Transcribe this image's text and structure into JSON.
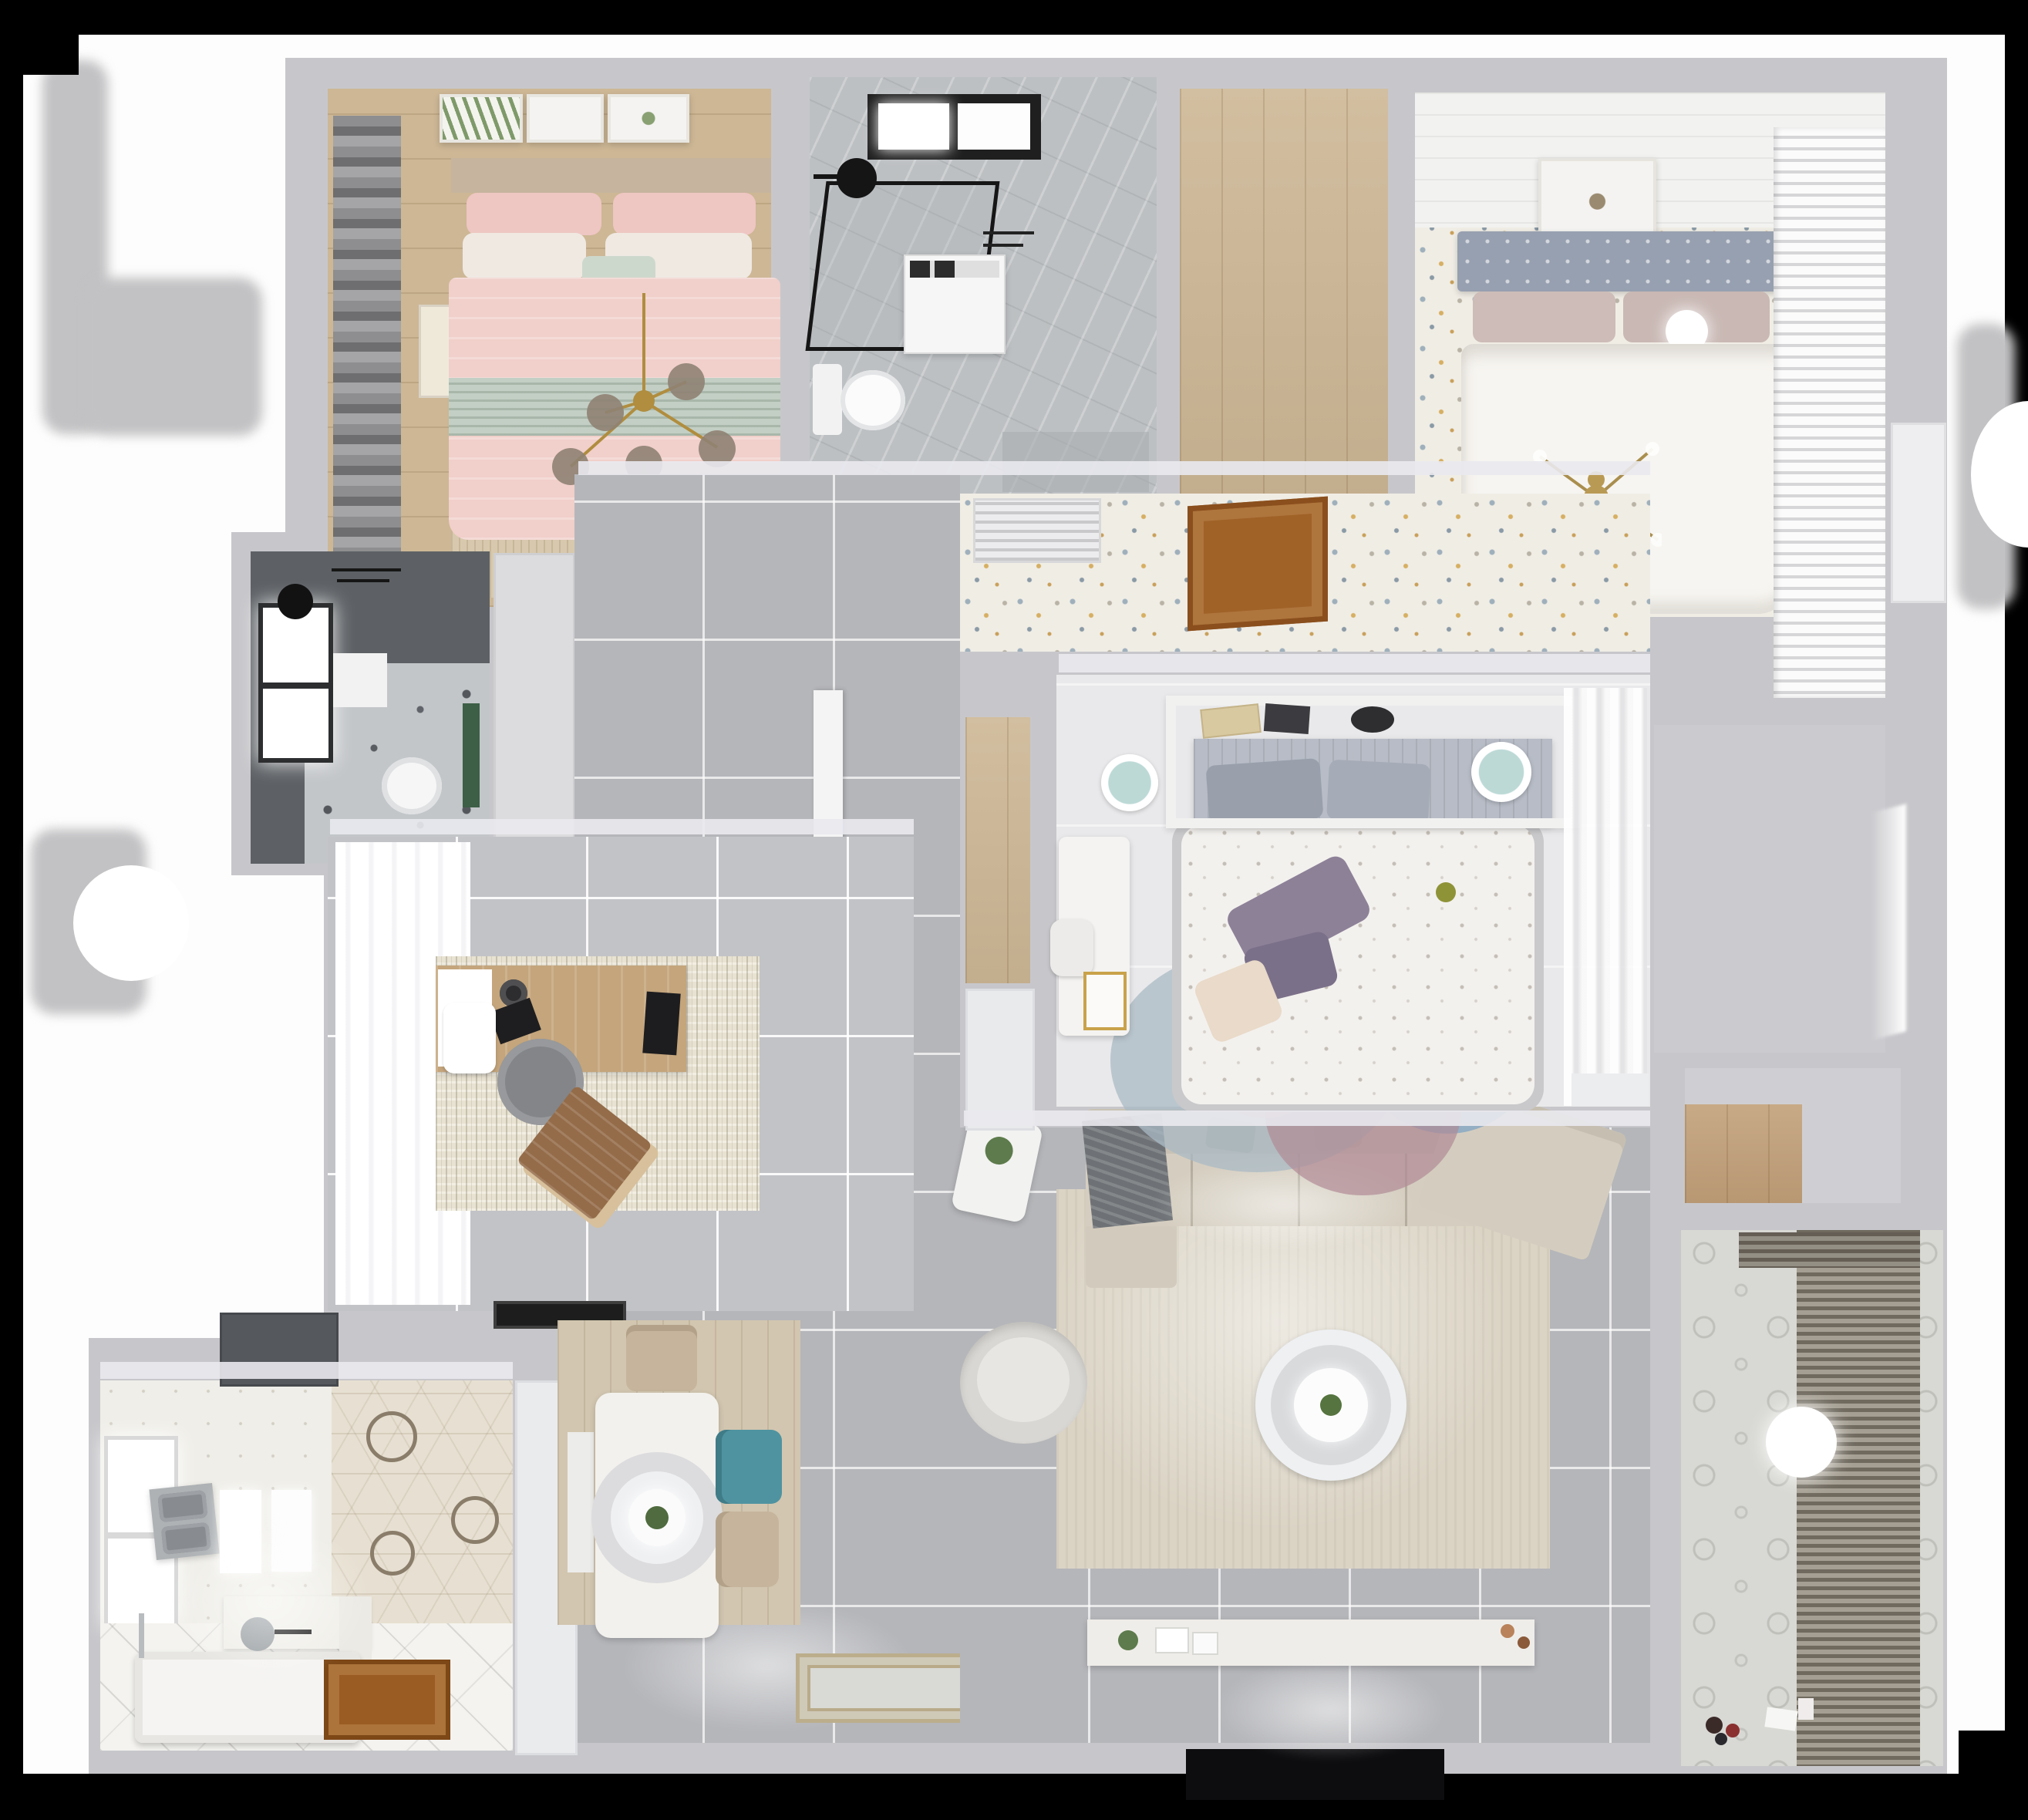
{
  "meta": {
    "title": "Top-down 3D dollhouse render of a furnished apartment floor plan",
    "view": "overhead cutaway, no visible text or UI controls"
  },
  "palette": {
    "canvas": "#fdfdfd",
    "wall": "#c7c7cb",
    "tile": "#b5b6ba",
    "wood": "#cdb795",
    "speckle": "#f0ede5",
    "pink": "#f1cfca",
    "sage": "#c3cfc4",
    "teal": "#4f93a0",
    "purple": "#8d8198",
    "sofa": "#d5cec0",
    "rugliving": "#dbd4c5",
    "doorwood": "#a06227",
    "blinds": "#6f695e",
    "headboard": "#97a0b0",
    "tv": "#0d0d0f",
    "plant": "#5d7b4c",
    "gold": "#b08d3f"
  },
  "rooms": [
    {
      "id": "bedroom-1",
      "name": "Bedroom 1 - blush bedroom",
      "items": [
        "double bed with blush duvet",
        "sage throw band",
        "gold branch chandelier",
        "three gallery frames",
        "roman shade curtains",
        "beige rug",
        "foot bench",
        "oak floor"
      ]
    },
    {
      "id": "bathroom-1",
      "name": "Bathroom 1 - marble shower room",
      "items": [
        "black framed walk-in shower",
        "black shower head",
        "skylight window",
        "toilet",
        "washing machine",
        "marble floor"
      ]
    },
    {
      "id": "closet",
      "name": "Walk-in closet",
      "items": [
        "oak plank floor"
      ]
    },
    {
      "id": "bedroom-2",
      "name": "Bedroom 2 - master bedroom",
      "items": [
        "white duvet double bed",
        "tufted blue-grey headboard",
        "mauve pillows",
        "sphere table lamp",
        "gold sputnik chandelier",
        "louvered wardrobe",
        "wall art",
        "confetti speckle carpet",
        "plank ceiling"
      ]
    },
    {
      "id": "corridor",
      "name": "Corridor",
      "items": [
        "air conditioning vent grille",
        "open wooden door",
        "potted plant on half wall"
      ]
    },
    {
      "id": "bathroom-2",
      "name": "Bathroom 2 - dark tiled shower",
      "items": [
        "ceiling shower head",
        "toilet",
        "window",
        "white bath mat",
        "green accent panel",
        "marble floor patch"
      ]
    },
    {
      "id": "hallway",
      "name": "Hallway",
      "items": [
        "grey porcelain floor tiles",
        "white door leaf"
      ]
    },
    {
      "id": "bedroom-3",
      "name": "Bedroom 3 - teen bedroom",
      "items": [
        "bed with floral duvet",
        "plum cushions",
        "cream cushion",
        "shelf headboard with books",
        "white desk and chair",
        "gold cart",
        "two teal poufs",
        "pastel circles rug",
        "sheer curtains",
        "oak niche",
        "white closet front"
      ]
    },
    {
      "id": "study",
      "name": "Study",
      "items": [
        "wooden desk",
        "monitor",
        "camera and lens",
        "white side chair",
        "grey desk chair",
        "tan lounge chair",
        "distressed rug",
        "sheer curtains",
        "black doormat"
      ]
    },
    {
      "id": "bathroom-3",
      "name": "Bathroom 3 - family bath",
      "items": [
        "freestanding bathtub",
        "floor standing tub filler",
        "wall mixer with spout",
        "stainless double sink",
        "twin glowing mirrors",
        "hexagon feature wall",
        "half wall counter",
        "wooden door",
        "window",
        "water heater box"
      ]
    },
    {
      "id": "dining",
      "name": "Dining area",
      "items": [
        "white dining table",
        "ring pendant lamp with plant",
        "teal chair",
        "two beige chairs",
        "white bench",
        "wood-look rug",
        "ornate entry mat"
      ]
    },
    {
      "id": "living",
      "name": "Living room",
      "items": [
        "L-shaped sectional sofa",
        "angled chaise",
        "grey throw",
        "two-tier round coffee table",
        "barrel armchair",
        "side table with plant",
        "TV console with decor",
        "wall TV",
        "large beige rug"
      ]
    },
    {
      "id": "balcony",
      "name": "Balcony",
      "items": [
        "slatted blinds",
        "drying rack rail",
        "patterned encaustic tiles",
        "round ceiling light",
        "toys and papers"
      ]
    },
    {
      "id": "niche",
      "name": "Storage niche",
      "items": [
        "wooden shelf"
      ]
    },
    {
      "id": "entry",
      "name": "Entry",
      "items": [
        "open front door with daylight"
      ]
    }
  ]
}
